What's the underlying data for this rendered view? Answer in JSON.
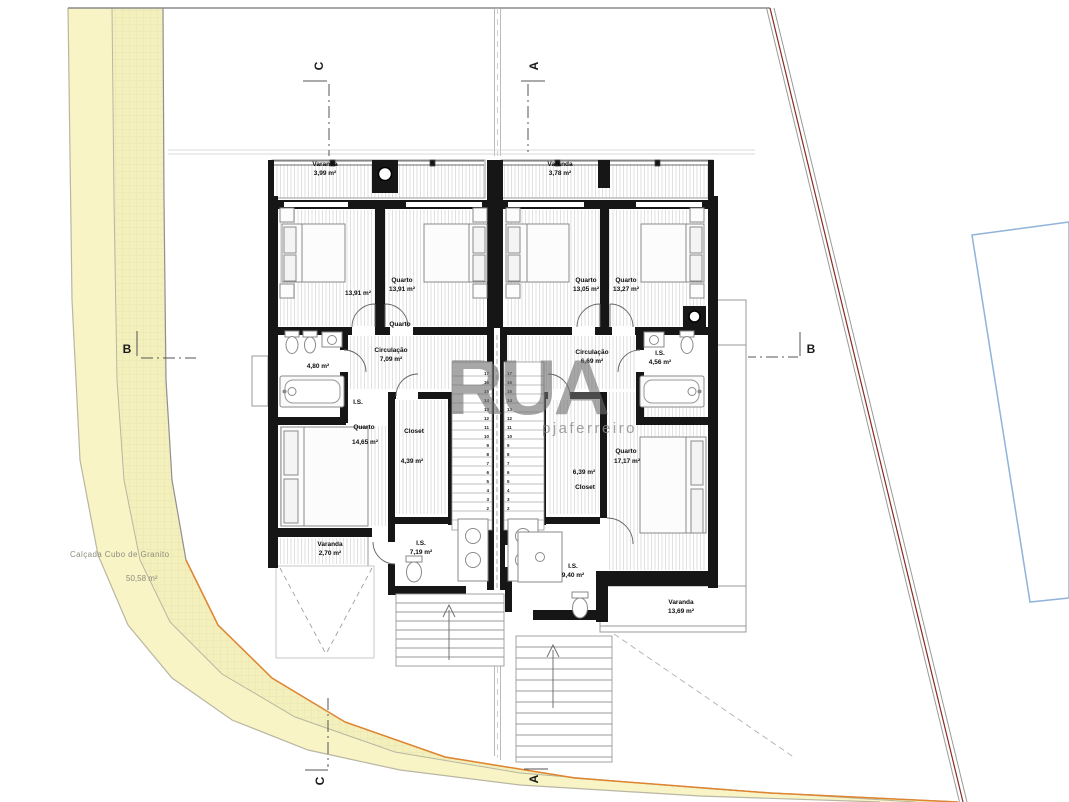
{
  "street": {
    "name": "Calçada Cubo de Granito",
    "area": "50,58 m²"
  },
  "watermark": {
    "brand": "RUA",
    "studio": "pjaferreiro"
  },
  "markers": {
    "a": "A",
    "b": "B",
    "c": "C"
  },
  "units": {
    "left": {
      "varanda_top": {
        "name": "Varanda",
        "area": "3,99 m²"
      },
      "quarto1": {
        "name": "Quarto",
        "area": "13,91 m²"
      },
      "quarto2": {
        "name": "Quarto",
        "area": "13,91 m²"
      },
      "circulacao": {
        "name": "Circulação",
        "area": "7,09 m²"
      },
      "is_top": {
        "name": "I.S.",
        "area": "4,80 m²"
      },
      "quarto3": {
        "name": "Quarto",
        "area": "14,65 m²"
      },
      "closet": {
        "name": "Closet",
        "area": "4,39 m²"
      },
      "varanda_bottom": {
        "name": "Varanda",
        "area": "2,70 m²"
      },
      "is_bottom": {
        "name": "I.S.",
        "area": "7,19 m²"
      }
    },
    "right": {
      "varanda_top": {
        "name": "Varanda",
        "area": "3,78 m²"
      },
      "quarto1": {
        "name": "Quarto",
        "area": "13,05 m²"
      },
      "quarto2": {
        "name": "Quarto",
        "area": "13,27 m²"
      },
      "circulacao": {
        "name": "Circulação",
        "area": "6,69 m²"
      },
      "is_top": {
        "name": "I.S.",
        "area": "4,56 m²"
      },
      "quarto3": {
        "name": "Quarto",
        "area": "17,17 m²"
      },
      "closet": {
        "name": "Closet",
        "area": "6,39 m²"
      },
      "is_bottom": {
        "name": "I.S.",
        "area": "9,40 m²"
      },
      "varanda_bottom": {
        "name": "Varanda",
        "area": "13,69 m²"
      }
    }
  },
  "stairs": {
    "left_numbers": [
      "17",
      "16",
      "15",
      "14",
      "13",
      "12",
      "11",
      "10",
      "9",
      "8",
      "7",
      "6",
      "5",
      "4",
      "3",
      "2"
    ],
    "right_numbers": [
      "17",
      "16",
      "15",
      "14",
      "13",
      "12",
      "11",
      "10",
      "9",
      "8",
      "7",
      "6",
      "5",
      "4",
      "3",
      "2"
    ]
  },
  "colors": {
    "street_fill": "#f8f4c6",
    "sidewalk_fill": "#f4f0bb",
    "curb_orange": "#e08631",
    "boundary_red": "#8a2a25",
    "pool_blue": "#8fb3d9",
    "wall_black": "#161616"
  }
}
